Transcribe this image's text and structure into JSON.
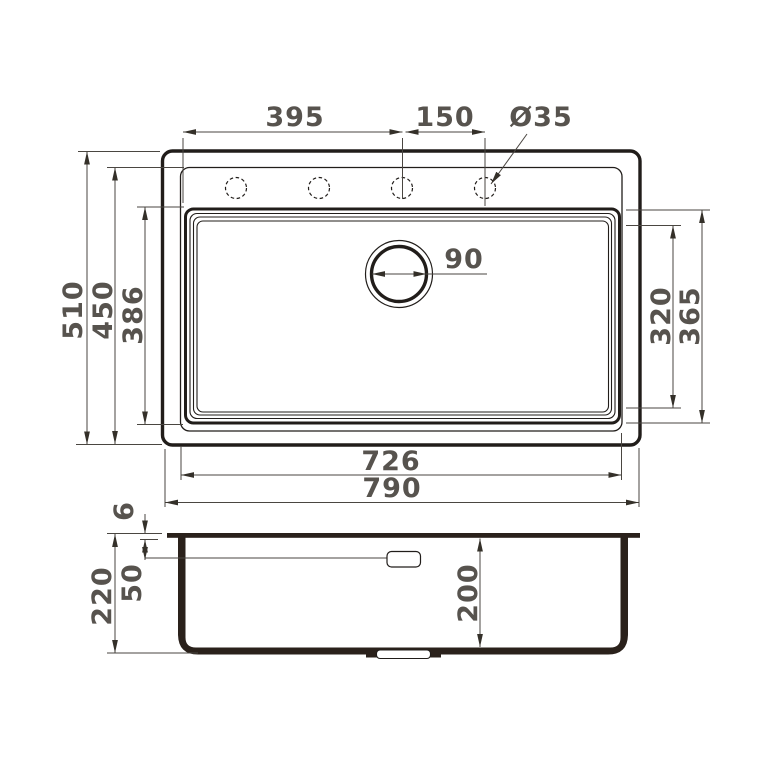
{
  "colors": {
    "line": "#211d1a",
    "fill": "#2a211b",
    "dim_line": "#4a4641",
    "arrow": "#343029",
    "text": "#57534e",
    "background": "#ffffff"
  },
  "top_view": {
    "dim_hole_offset": "395",
    "dim_hole_spacing": "150",
    "dim_hole_diameter": "Ø35",
    "dim_drain_diameter": "90",
    "dim_overall_depth": "510",
    "dim_deck_depth": "450",
    "dim_bowl_depth": "386",
    "dim_bowl_inner_span": "320",
    "dim_bowl_outer_span": "365",
    "dim_bowl_width": "726",
    "dim_overall_width": "790"
  },
  "section_view": {
    "dim_rim_thickness": "6",
    "dim_overflow_offset": "50",
    "dim_overall_height": "220",
    "dim_bowl_depth": "200"
  }
}
